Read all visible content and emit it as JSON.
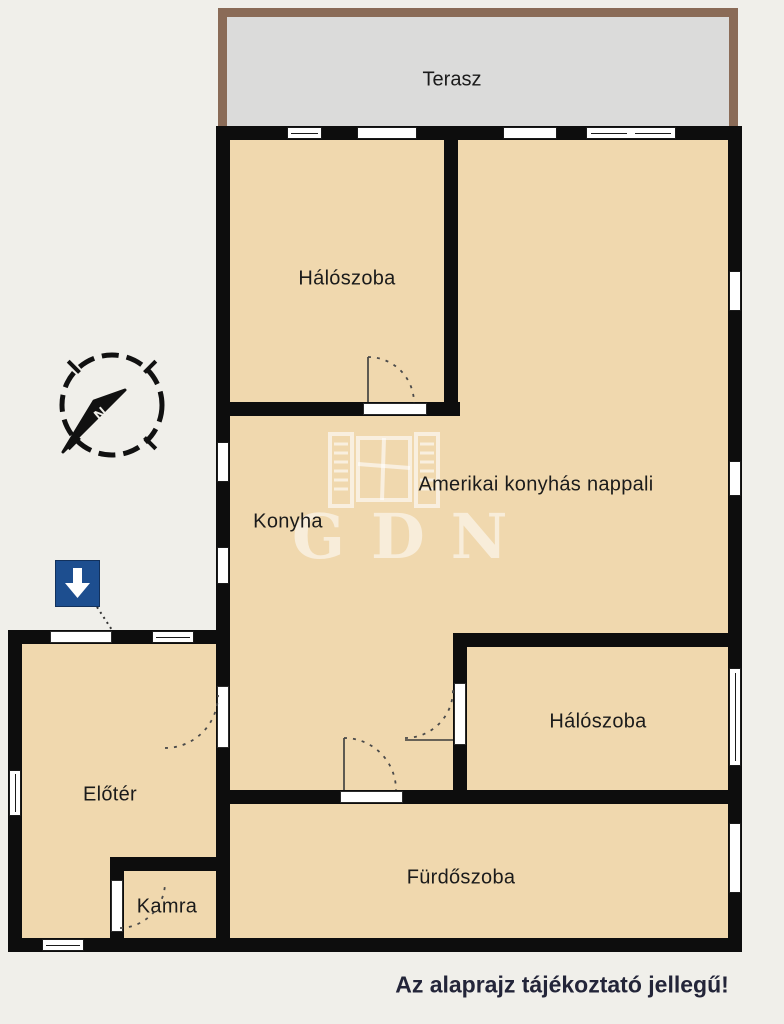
{
  "floorplan": {
    "terrace": {
      "label": "Terasz"
    },
    "rooms": [
      {
        "id": "bedroom-top",
        "label": "Hálószoba"
      },
      {
        "id": "living-room",
        "label": "Amerikai konyhás nappali"
      },
      {
        "id": "kitchen",
        "label": "Konyha"
      },
      {
        "id": "bedroom-right",
        "label": "Hálószoba"
      },
      {
        "id": "hallway",
        "label": "Előtér"
      },
      {
        "id": "pantry",
        "label": "Kamra"
      },
      {
        "id": "bathroom",
        "label": "Fürdőszoba"
      }
    ],
    "compass": {
      "north_label": "N"
    },
    "watermark": {
      "text": "GDN"
    },
    "disclaimer": "Az alaprajz tájékoztató jellegű!",
    "colors": {
      "background": "#f0efea",
      "room_fill": "#f0d8ae",
      "terrace_fill": "#dbdbda",
      "terrace_border": "#8a6b57",
      "wall": "#0d0d0d",
      "entrance_marker_blue": "#1d4e8f",
      "watermark": "#f7ecd6",
      "disclaimer_text": "#232539"
    }
  }
}
